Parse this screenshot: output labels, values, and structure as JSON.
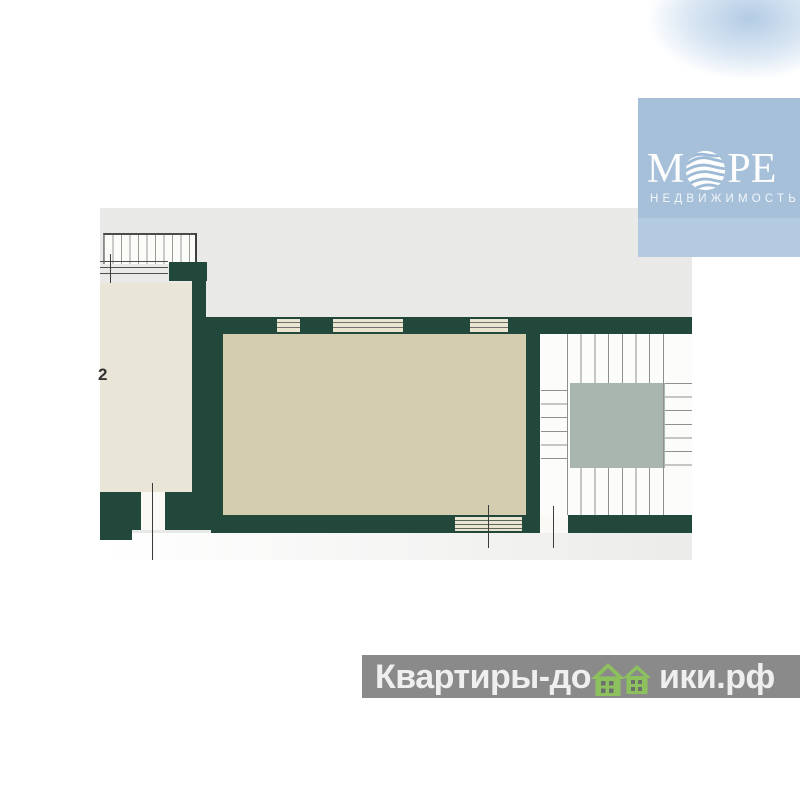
{
  "logo": {
    "brand_full": "МОРЕ",
    "brand_left": "М",
    "brand_right": "РЕ",
    "subtitle": "НЕДВИЖИМОСТЬ",
    "globe_icon": "globe-wave-sphere-icon"
  },
  "watermark": {
    "full_text": "Квартиры-домики.рф",
    "part1": "Квартиры-до",
    "part2": "ики.рф",
    "houses_icon": "twin-house-icon"
  },
  "floorplan": {
    "room_label": "2"
  },
  "colors": {
    "plan_bg": "#e9e9e7",
    "wall": "#21483a",
    "room_main": "#d5cdb0",
    "room_left": "#e9e5d7",
    "opening_fill": "#eae5d1",
    "elevator": "#a9b5af",
    "stair_line": "#90908e",
    "logo_bg": "#a6c0da",
    "logo_bg_light": "#b4cae1",
    "watermark_bg": "#8a8a8a",
    "watermark_text": "#efefef",
    "house_green": "#8cc15d"
  }
}
